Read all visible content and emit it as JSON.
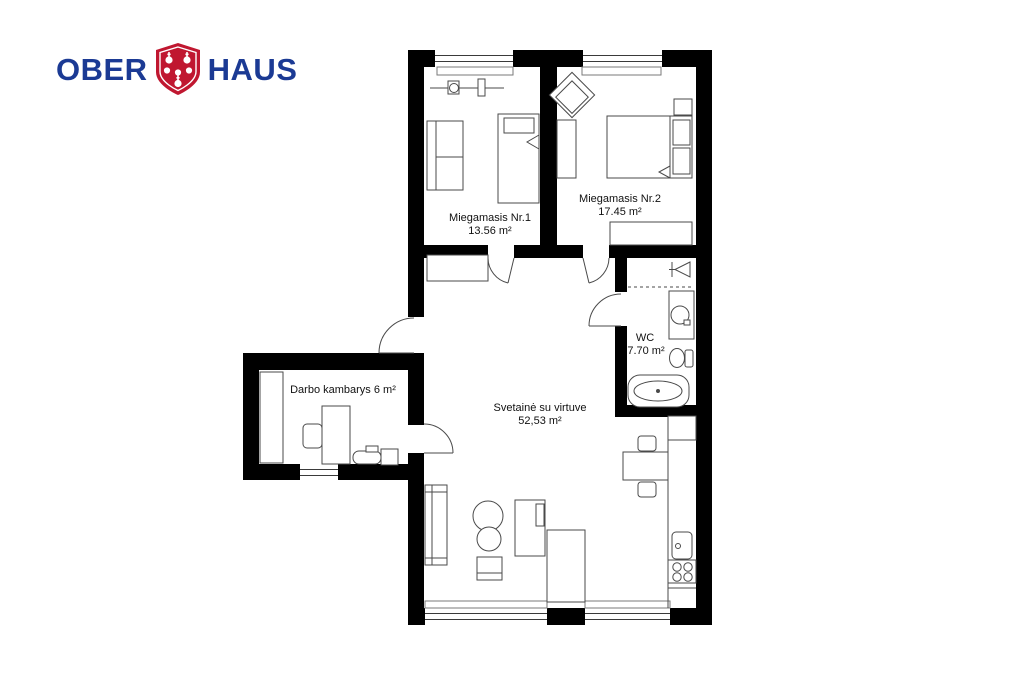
{
  "logo": {
    "word1": "OBER",
    "word2": "HAUS",
    "text_color": "#1b3a94",
    "shield_color": "#c01730"
  },
  "plan": {
    "wall_color": "#000000",
    "furniture_line_color": "#4a4a4a",
    "label_color": "#111111",
    "rooms": [
      {
        "name": "Miegamasis Nr.1",
        "area": "13.56 m²"
      },
      {
        "name": "Miegamasis Nr.2",
        "area": "17.45 m²"
      },
      {
        "name": "WC",
        "area": "7.70 m²"
      },
      {
        "name": "Svetainė su virtuve",
        "area": "52,53 m²"
      },
      {
        "name": "Darbo kambarys 6 m²",
        "area": ""
      }
    ]
  }
}
